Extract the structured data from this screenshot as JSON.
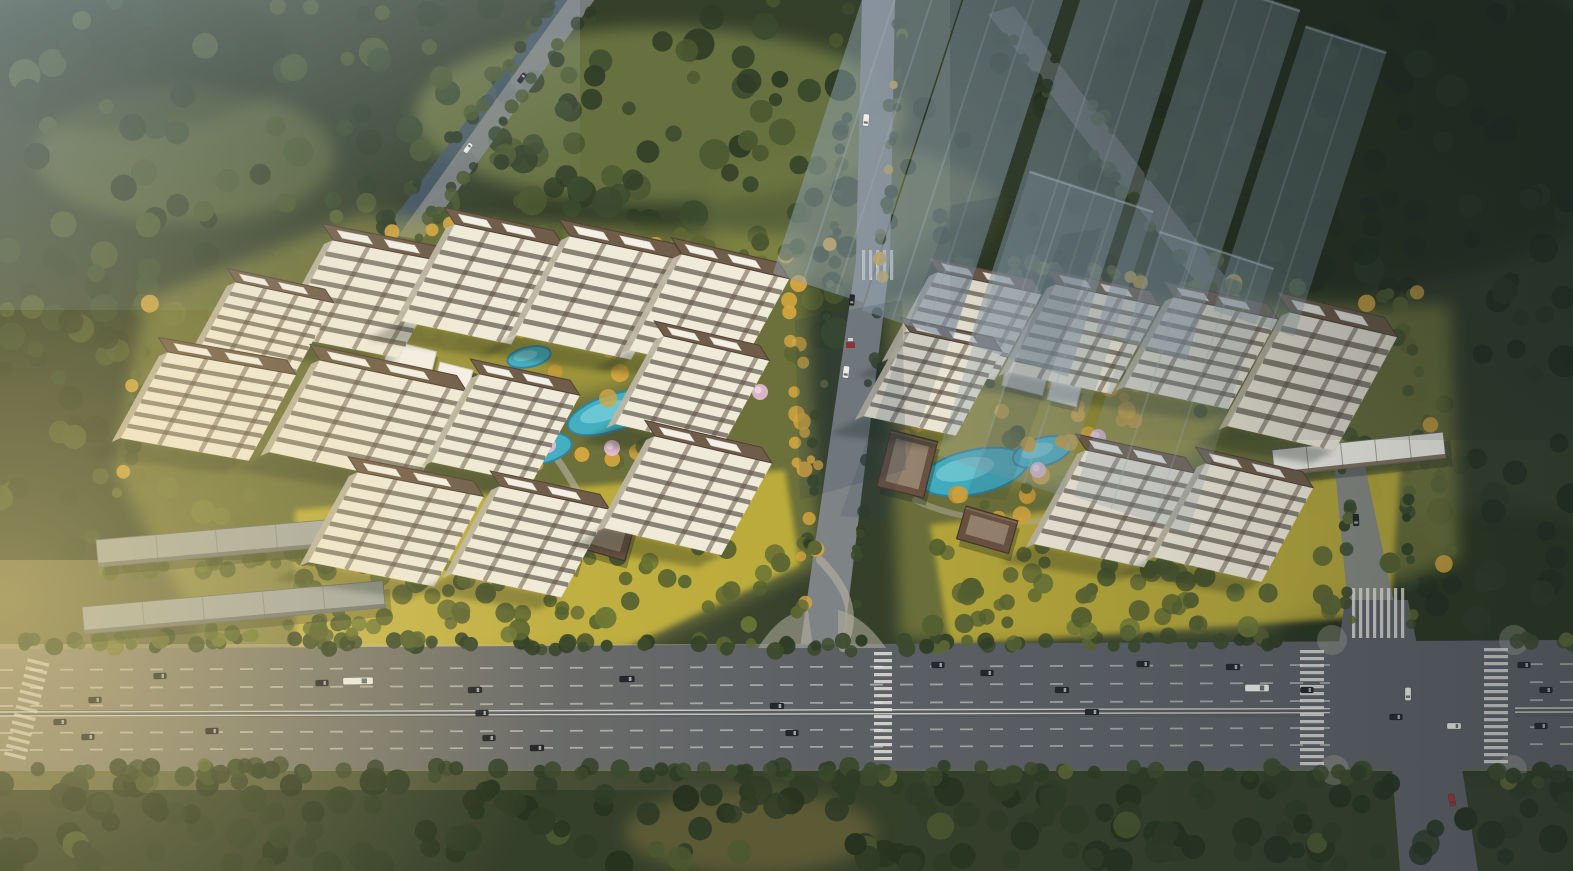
{
  "meta": {
    "type": "architectural-aerial-rendering",
    "subject": "bird's-eye view of a two-parcel residential development beside a wide arterial boulevard, surrounded by dense forest, with translucent future-phase towers in the upper right and warm low sunlight from the left",
    "visible_text": "none"
  },
  "palette": {
    "forest": "#35402b",
    "forestDark": "#25301f",
    "meadow": "#6d7742",
    "treeGreen": "#4a5830",
    "treeDark": "#2f3c26",
    "treeOlive": "#5c6633",
    "treeGold": "#d4a63f",
    "treeGoldDeep": "#c89a38",
    "treeBlossom": "#e7bcd8",
    "lawn": "#d6bf3a",
    "lawnOlive": "#a3a149",
    "road": "#5c6065",
    "roadWarm": "#958a76",
    "roadLight": "#83878b",
    "sidewalk": "#b5b0a3",
    "marking": "#eceae2",
    "canal": "#44566b",
    "poolBlue": "#41b3c8",
    "poolLight": "#93dfe8",
    "poolDeep": "#2f84a6",
    "facade": "#f0ead9",
    "facadeShade": "#bdb5a2",
    "windowBand": "#6e675a",
    "accentBand": "#5f5143",
    "roof": "#6f5c49",
    "roofDark": "#4e4136",
    "roofWhite": "#f3f0e7",
    "gate": "#6b5242",
    "gateInner": "#9c8873",
    "lowrise": "#a2a7a5",
    "lowriseSeam": "#7e837f",
    "ghost": "#8fa2b2",
    "ghostEdge": "#c3cfd8",
    "haze": "#b9cad8",
    "sun": "#f2d98c",
    "cool": "#16222b",
    "vignette": "#101b20",
    "shadow": "#1e2a22",
    "streak": "#273a4e",
    "pathCol": "#b7b2a2",
    "carDark": "#24282c",
    "carWhite": "#edece6",
    "carRed": "#a03531",
    "booth": "#a03531"
  },
  "scene": {
    "west_parcel": {
      "label": "west residential compound with tiled-roof towers around a landscaped pool courtyard",
      "towers": [
        [
          333,
          240,
          120,
          95,
          11
        ],
        [
          455,
          224,
          112,
          97,
          12
        ],
        [
          570,
          236,
          118,
          99,
          12
        ],
        [
          682,
          254,
          110,
          96,
          13
        ],
        [
          236,
          282,
          100,
          80,
          12
        ],
        [
          168,
          352,
          130,
          86,
          10
        ],
        [
          320,
          360,
          150,
          92,
          12
        ],
        [
          480,
          374,
          102,
          88,
          12
        ],
        [
          358,
          472,
          128,
          90,
          11
        ],
        [
          500,
          486,
          112,
          88,
          12
        ],
        [
          664,
          336,
          108,
          88,
          13
        ],
        [
          655,
          436,
          120,
          92,
          13
        ]
      ],
      "pools": [
        [
          447,
          436,
          50,
          20,
          -14
        ],
        [
          530,
          449,
          42,
          17,
          -8
        ],
        [
          612,
          413,
          46,
          18,
          -18
        ],
        [
          663,
          391,
          26,
          12,
          -20
        ],
        [
          529,
          357,
          22,
          10,
          -12
        ]
      ],
      "gates": [
        [
          583,
          503,
          56,
          44,
          16
        ],
        [
          553,
          540,
          30,
          22,
          16
        ]
      ],
      "clubhouses": [
        [
          390,
          340,
          48,
          30,
          14
        ],
        [
          440,
          362,
          34,
          22,
          14
        ],
        [
          618,
          300,
          40,
          26,
          14
        ]
      ],
      "lowrise_rows": [
        [
          96,
          540,
          300,
          27,
          -5,
          "grey"
        ],
        [
          82,
          607,
          302,
          27,
          -5,
          "grey"
        ]
      ]
    },
    "east_parcel": {
      "label": "east residential compound with gate pavilions and pool garden",
      "towers": [
        [
          938,
          272,
          106,
          86,
          12
        ],
        [
          1056,
          284,
          106,
          88,
          12
        ],
        [
          1174,
          297,
          106,
          90,
          12
        ],
        [
          1290,
          312,
          110,
          114,
          13
        ],
        [
          910,
          332,
          94,
          84,
          12
        ],
        [
          1086,
          450,
          112,
          94,
          12
        ],
        [
          1206,
          463,
          110,
          94,
          13
        ]
      ],
      "pools": [
        [
          974,
          472,
          54,
          22,
          -12
        ],
        [
          1042,
          452,
          30,
          14,
          -16
        ]
      ],
      "gates": [
        [
          891,
          430,
          48,
          58,
          14
        ],
        [
          966,
          506,
          54,
          34,
          16
        ]
      ],
      "clubhouses": [
        [
          1008,
          360,
          42,
          26,
          14
        ],
        [
          1052,
          380,
          30,
          20,
          14
        ]
      ],
      "lowrise_rows": [
        [
          1272,
          450,
          172,
          26,
          -6,
          "white"
        ]
      ]
    },
    "ghost_towers": {
      "label": "translucent future-phase high-rises, upper right",
      "slabs": [
        [
          878,
          -50,
          95,
          340,
          18,
          0.5
        ],
        [
          986,
          -70,
          95,
          400,
          18,
          0.55
        ],
        [
          1098,
          -55,
          105,
          420,
          18,
          0.5
        ],
        [
          1210,
          -20,
          95,
          370,
          18,
          0.45
        ],
        [
          1306,
          25,
          85,
          300,
          18,
          0.38
        ],
        [
          1030,
          170,
          130,
          300,
          18,
          0.32
        ],
        [
          1160,
          230,
          120,
          280,
          18,
          0.26
        ]
      ]
    },
    "blossom_trees": [
      [
        510,
        430
      ],
      [
        548,
        445
      ],
      [
        612,
        448
      ],
      [
        444,
        418
      ],
      [
        1038,
        470
      ],
      [
        1098,
        437
      ],
      [
        760,
        392
      ]
    ],
    "vehicles": {
      "label": "cars, buses and trucks on the boulevard and side roads",
      "items": [
        [
          160,
          676,
          13,
          6,
          -1,
          "d"
        ],
        [
          322,
          683,
          13,
          6,
          -1,
          "d"
        ],
        [
          475,
          690,
          14,
          6,
          -1,
          "d"
        ],
        [
          358,
          681,
          30,
          7,
          -1,
          "w"
        ],
        [
          627,
          679,
          15,
          6,
          -1,
          "d"
        ],
        [
          777,
          706,
          14,
          6,
          0,
          "d"
        ],
        [
          938,
          665,
          13,
          6,
          0,
          "d"
        ],
        [
          987,
          673,
          13,
          6,
          0,
          "d"
        ],
        [
          1062,
          690,
          14,
          6,
          0,
          "d"
        ],
        [
          1143,
          664,
          13,
          6,
          0,
          "d"
        ],
        [
          1233,
          667,
          14,
          6,
          0,
          "d"
        ],
        [
          1307,
          690,
          13,
          6,
          0,
          "d"
        ],
        [
          1524,
          665,
          13,
          6,
          0,
          "d"
        ],
        [
          1546,
          690,
          13,
          6,
          0,
          "d"
        ],
        [
          95,
          700,
          13,
          6,
          -1,
          "d"
        ],
        [
          60,
          722,
          13,
          6,
          -1,
          "d"
        ],
        [
          88,
          737,
          13,
          6,
          -1,
          "d"
        ],
        [
          212,
          731,
          13,
          6,
          -1,
          "d"
        ],
        [
          482,
          713,
          13,
          6,
          -1,
          "d"
        ],
        [
          489,
          738,
          13,
          6,
          -1,
          "d"
        ],
        [
          537,
          748,
          14,
          6,
          -1,
          "d"
        ],
        [
          792,
          733,
          13,
          6,
          0,
          "d"
        ],
        [
          1092,
          712,
          14,
          6,
          0,
          "d"
        ],
        [
          1257,
          688,
          24,
          7,
          0,
          "w"
        ],
        [
          1396,
          717,
          13,
          6,
          0,
          "d"
        ],
        [
          1454,
          726,
          14,
          6,
          0,
          "w"
        ],
        [
          1541,
          726,
          13,
          6,
          0,
          "d"
        ],
        [
          866,
          120,
          12,
          6,
          95,
          "w"
        ],
        [
          852,
          300,
          11,
          5,
          95,
          "d"
        ],
        [
          846,
          372,
          12,
          6,
          97,
          "w"
        ],
        [
          1356,
          520,
          12,
          6,
          88,
          "d"
        ],
        [
          1408,
          694,
          13,
          6,
          90,
          "w"
        ],
        [
          1452,
          800,
          12,
          6,
          78,
          "r"
        ],
        [
          522,
          78,
          11,
          5,
          -53,
          "d"
        ],
        [
          468,
          148,
          11,
          5,
          -53,
          "w"
        ]
      ]
    },
    "gate_booth": [
      846,
      342
    ]
  }
}
